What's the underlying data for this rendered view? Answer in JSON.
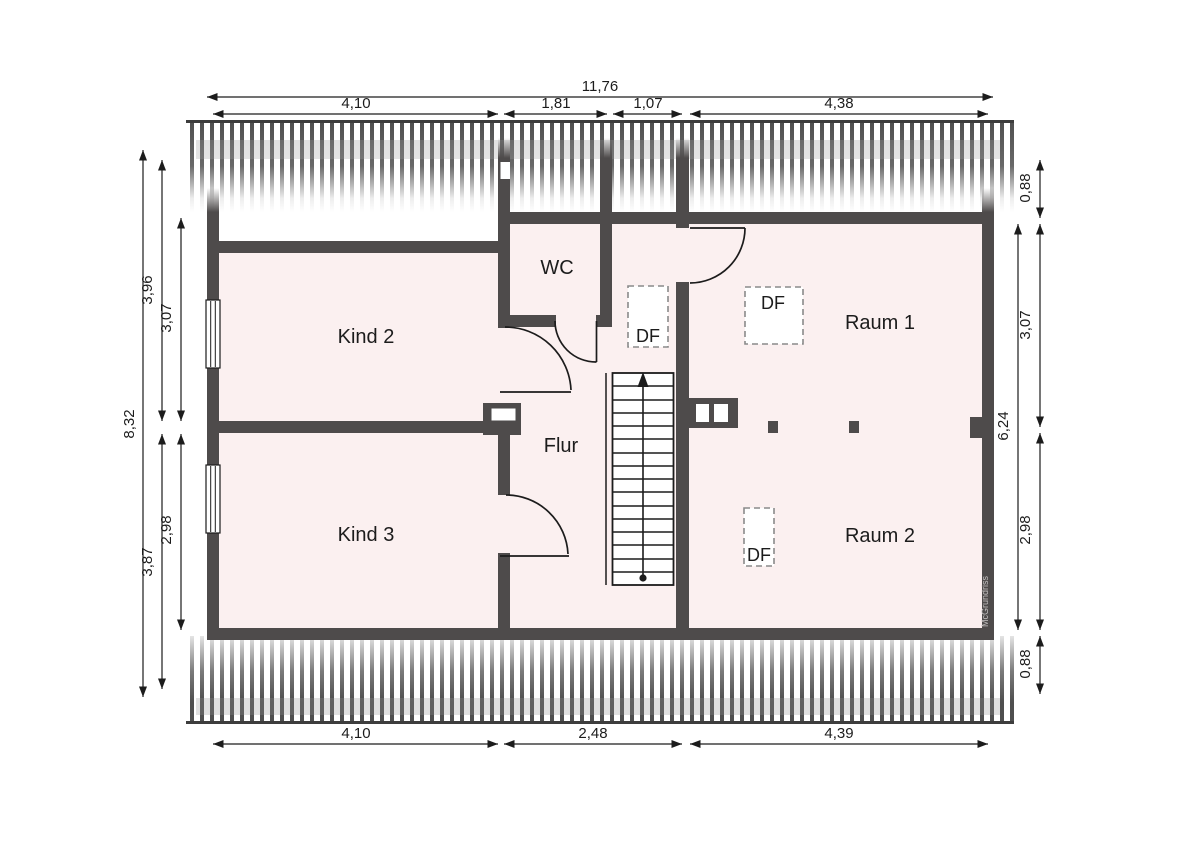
{
  "plan": {
    "watermark": "McGrundriss",
    "rooms": [
      {
        "id": "kind2",
        "label": "Kind 2"
      },
      {
        "id": "kind3",
        "label": "Kind 3"
      },
      {
        "id": "wc",
        "label": "WC"
      },
      {
        "id": "flur",
        "label": "Flur"
      },
      {
        "id": "raum1",
        "label": "Raum 1"
      },
      {
        "id": "raum2",
        "label": "Raum 2"
      }
    ],
    "roof_windows": [
      {
        "id": "df-middle",
        "label": "DF"
      },
      {
        "id": "df-raum1",
        "label": "DF"
      },
      {
        "id": "df-raum2",
        "label": "DF"
      }
    ],
    "dimensions_m": {
      "top_total": "11,76",
      "top": [
        "4,10",
        "1,81",
        "1,07",
        "4,38"
      ],
      "bottom": [
        "4,10",
        "2,48",
        "4,39"
      ],
      "left_total": "8,32",
      "left_outer": [
        "3,96",
        "3,87"
      ],
      "left_inner": [
        "3,07",
        "2,98"
      ],
      "right": [
        "0,88",
        "3,07",
        "2,98",
        "0,88"
      ],
      "right_inner_total": "6,24"
    },
    "colors": {
      "wall": "#4e4b4b",
      "room_fill": "#fbf0f0",
      "line": "#1c1c1c",
      "hatch": "#4f4f4f",
      "dash_box": "#8a8a8a"
    }
  }
}
